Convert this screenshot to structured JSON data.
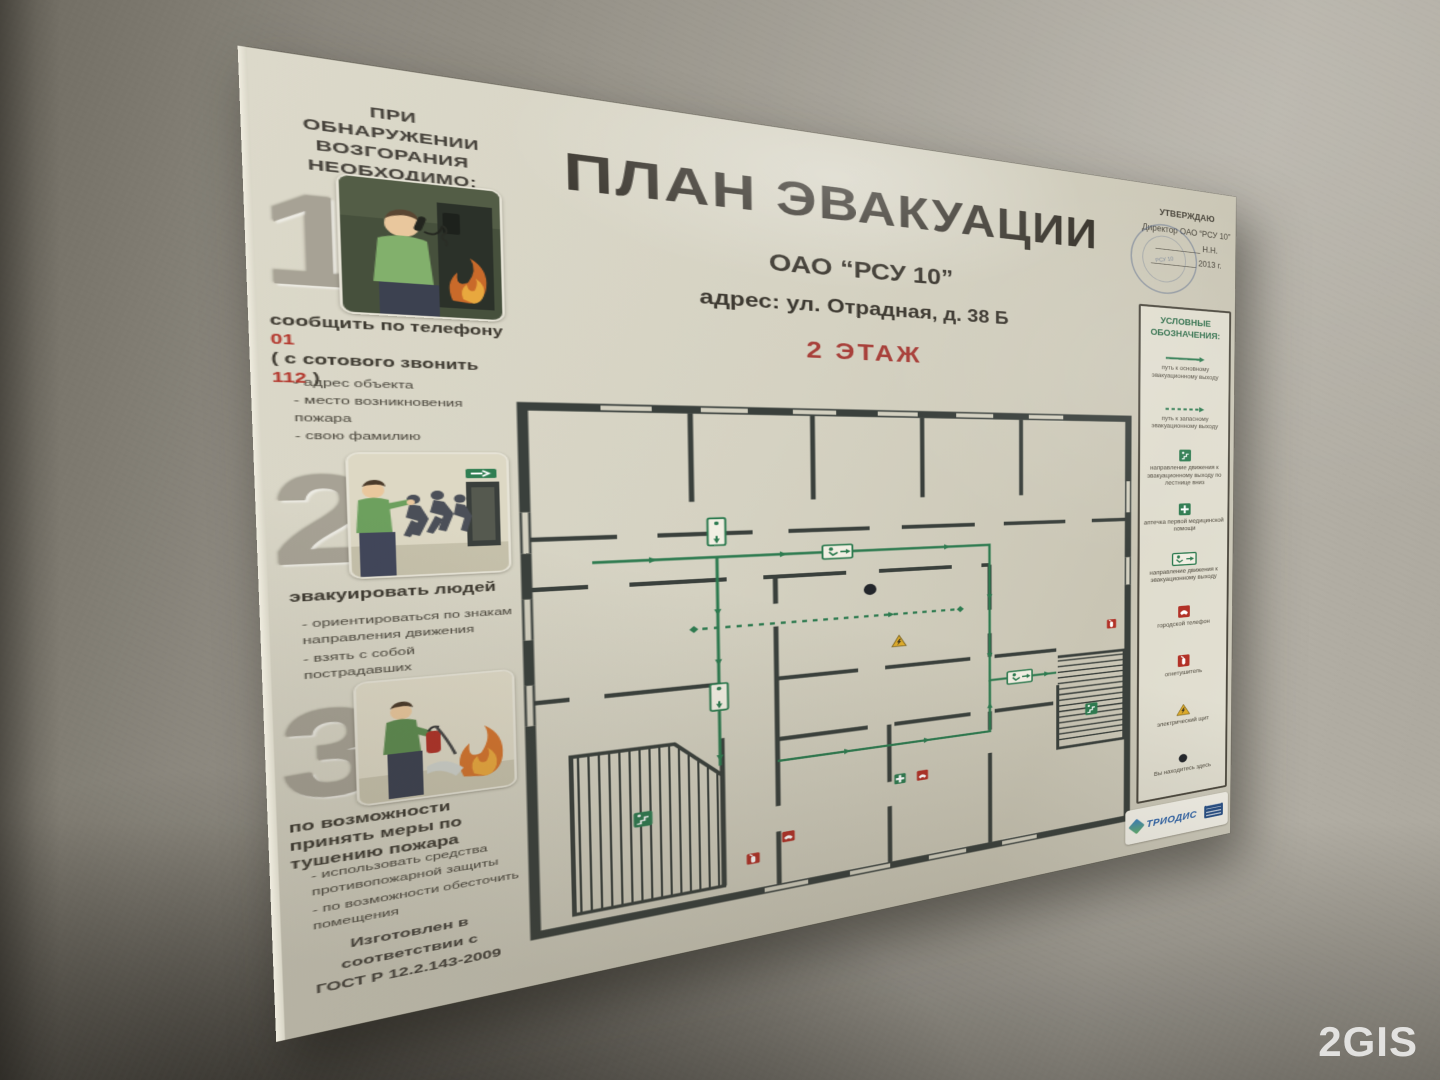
{
  "photo": {
    "watermark": "2GIS"
  },
  "board": {
    "left_panel": {
      "header": "ПРИ ОБНАРУЖЕНИИ\nВОЗГОРАНИЯ\nНЕОБХОДИМО:",
      "steps": [
        {
          "number": "1",
          "illustration": "человек сообщает о пожаре по телефону",
          "caption_pre": "сообщить по телефону ",
          "caption_red1": "01",
          "caption_mid": "( с сотового звонить ",
          "caption_red2": "112",
          "caption_post": " )",
          "bullets": [
            "- адрес объекта",
            "- место возникновения пожара",
            "- свою фамилию"
          ]
        },
        {
          "number": "2",
          "illustration": "эвакуация людей через выход",
          "caption": "эвакуировать людей",
          "bullets": [
            "- ориентироваться по знакам направления движения",
            "- взять с собой пострадавших"
          ]
        },
        {
          "number": "3",
          "illustration": "тушение пожара огнетушителем",
          "caption": "по возможности принять меры по тушению пожара",
          "bullets": [
            "- использовать средства противопожарной защиты",
            "- по возможности обесточить помещения"
          ]
        }
      ],
      "footer": "Изготовлен в соответствии с\nГОСТ Р 12.2.143-2009"
    },
    "center": {
      "title": "ПЛАН ЭВАКУАЦИИ",
      "organization": "ОАО “РСУ 10”",
      "address": "адрес: ул. Отрадная, д. 38 Б",
      "floor_label": "2 ЭТАЖ"
    },
    "right_panel": {
      "approval": [
        "УТВЕРЖДАЮ",
        "Директор ОАО “РСУ 10”",
        "__________ Н.Н.",
        "__________ 2013 г."
      ],
      "stamp_text": "РСУ 10",
      "legend_title": "УСЛОВНЫЕ\nОБОЗНАЧЕНИЯ:",
      "legend": [
        {
          "icon": "main-route-line",
          "label": "путь к основному эвакуационному выходу"
        },
        {
          "icon": "secondary-route-dashed-line",
          "label": "путь к запасному эвакуационному выходу"
        },
        {
          "icon": "exit-downstairs-sign",
          "label": "направление движения к эвакуационному выходу по лестнице вниз"
        },
        {
          "icon": "first-aid-sign",
          "label": "аптечка первой медицинской помощи"
        },
        {
          "icon": "exit-direction-sign",
          "label": "направление движения к эвакуационному выходу"
        },
        {
          "icon": "city-phone-sign",
          "label": "городской телефон"
        },
        {
          "icon": "fire-extinguisher-sign",
          "label": "огнетушитель"
        },
        {
          "icon": "electrical-panel-sign",
          "label": "электрический щит"
        },
        {
          "icon": "you-are-here-mark",
          "label": "Вы находитесь здесь"
        }
      ],
      "manufacturer": "ТРИОДИС"
    }
  }
}
